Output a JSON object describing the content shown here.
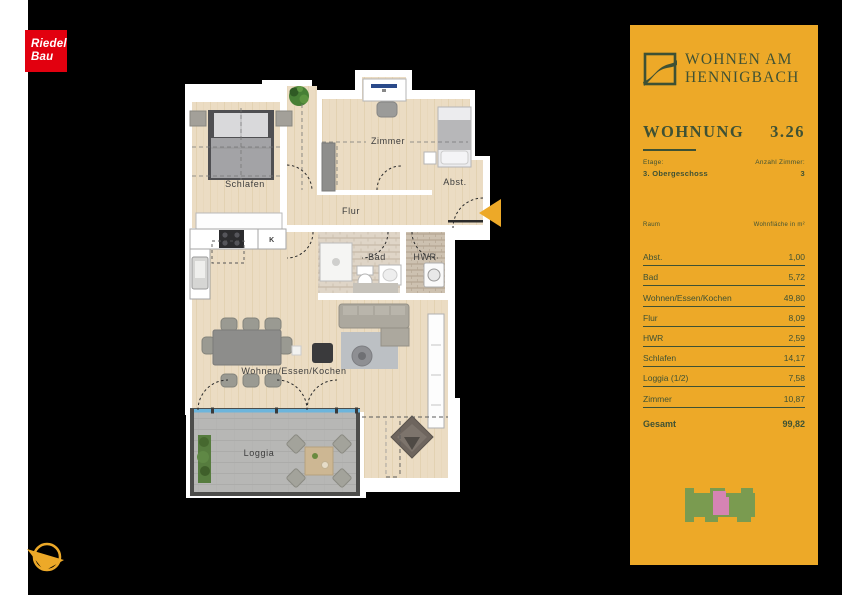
{
  "colors": {
    "accent": "#EDA928",
    "panel-green": "#3E5134",
    "logo-red": "#E2000F",
    "footprint-green": "#7A9B50",
    "footprint-pink": "#D584B4",
    "window-blue": "#6CB5DC"
  },
  "logo": {
    "line1": "Riedel",
    "line2": "Bau"
  },
  "brand": {
    "line1": "WOHNEN AM",
    "line2": "HENNIGBACH"
  },
  "apartment": {
    "title_label": "WOHNUNG",
    "unit_number": "3.26",
    "floor_label": "Etage:",
    "floor_value": "3. Obergeschoss",
    "rooms_label": "Anzahl Zimmer:",
    "rooms_value": "3"
  },
  "area_table": {
    "col_room": "Raum",
    "col_area": "Wohnfläche in m²",
    "rows": [
      {
        "room": "Abst.",
        "area": "1,00"
      },
      {
        "room": "Bad",
        "area": "5,72"
      },
      {
        "room": "Wohnen/Essen/Kochen",
        "area": "49,80"
      },
      {
        "room": "Flur",
        "area": "8,09"
      },
      {
        "room": "HWR",
        "area": "2,59"
      },
      {
        "room": "Schlafen",
        "area": "14,17"
      },
      {
        "room": "Loggia (1/2)",
        "area": "7,58"
      },
      {
        "room": "Zimmer",
        "area": "10,87"
      }
    ],
    "total_label": "Gesamt",
    "total_value": "99,82"
  },
  "floorplan": {
    "labels": {
      "schlafen": "Schlafen",
      "zimmer": "Zimmer",
      "abst": "Abst.",
      "flur": "Flur",
      "bad": "Bad",
      "hwr": "HWR",
      "wohnen": "Wohnen/Essen/Kochen",
      "loggia": "Loggia"
    },
    "kitchen_marker": "K"
  }
}
